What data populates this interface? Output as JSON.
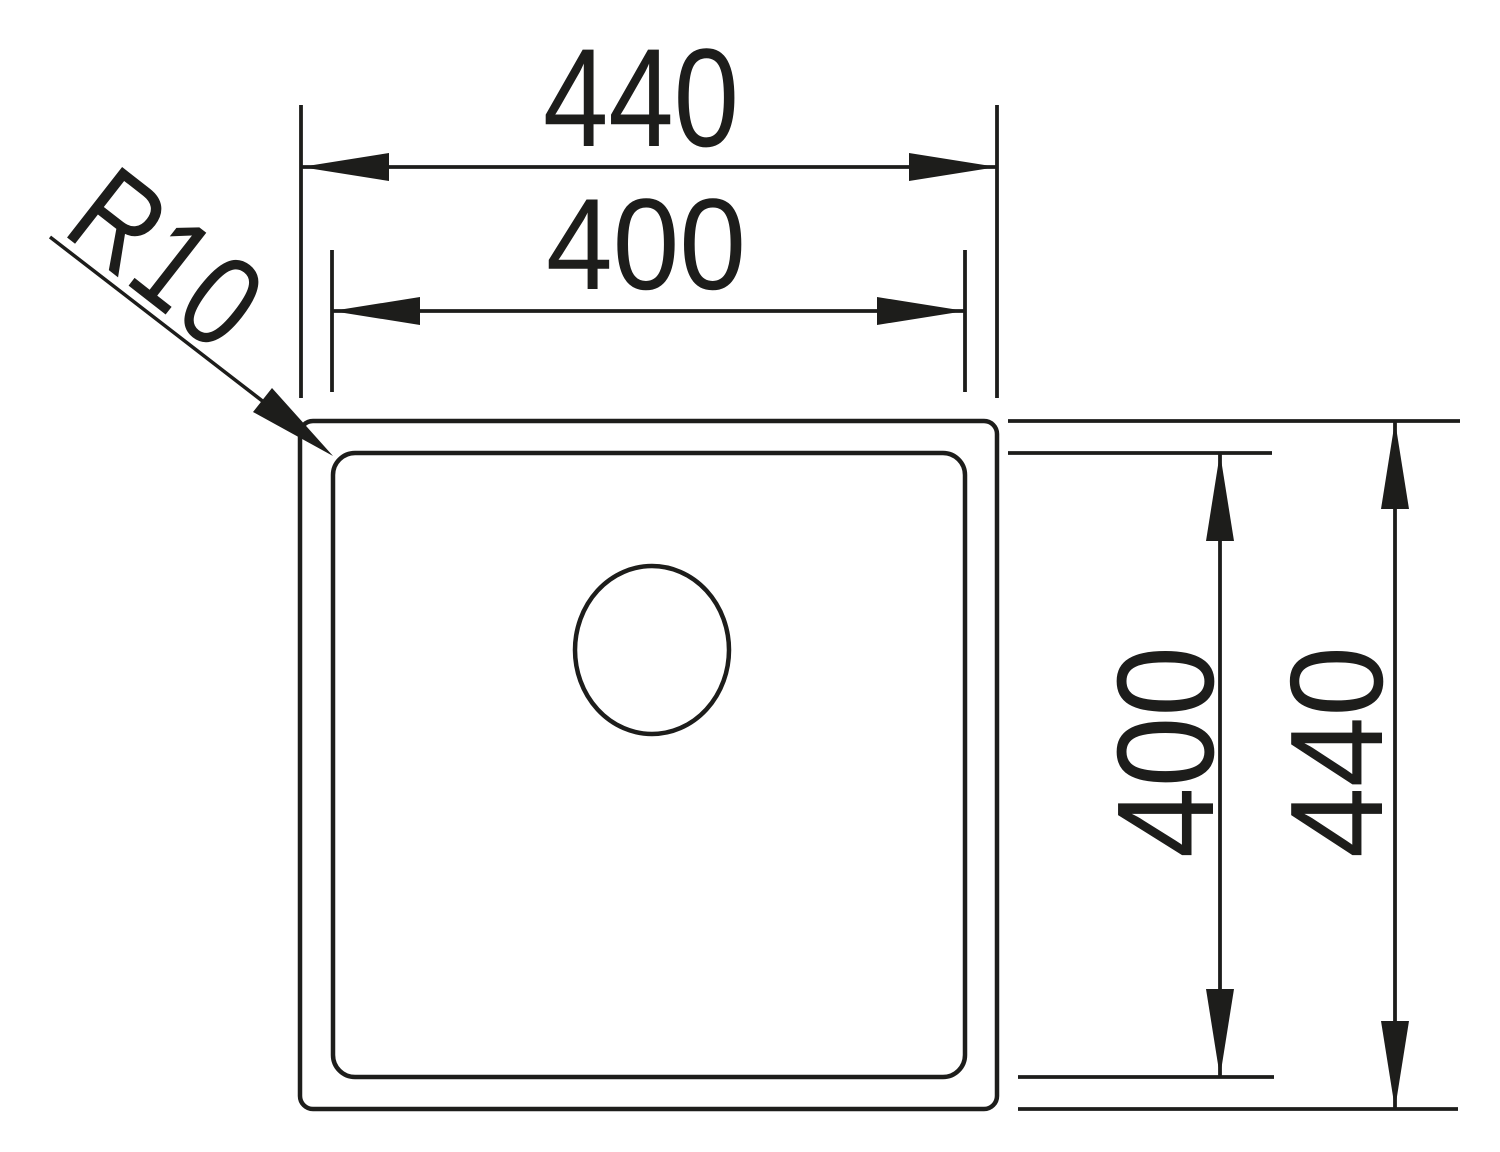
{
  "diagram": {
    "colors": {
      "background": "#ffffff",
      "line": "#1d1d1b"
    },
    "labels": {
      "top_width_outer": "440",
      "top_width_inner": "400",
      "right_height_inner": "400",
      "right_height_outer": "440",
      "corner_radius": "R10"
    }
  }
}
